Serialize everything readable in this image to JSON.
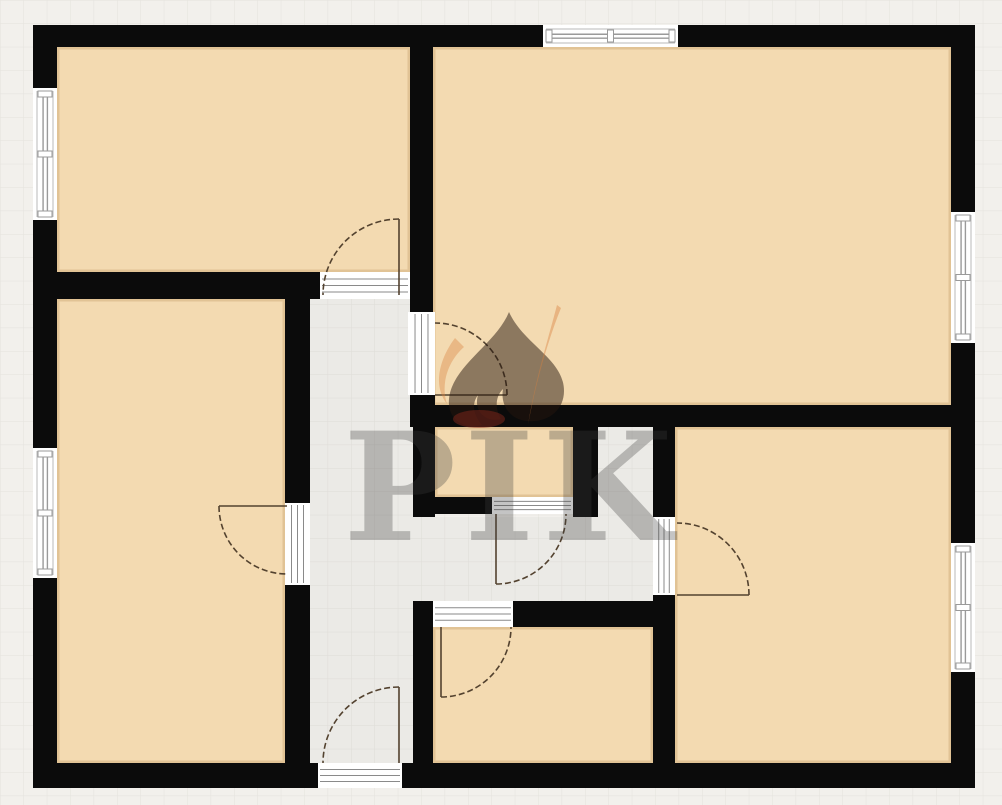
{
  "watermark": {
    "text": "PIK",
    "logo": "pik-flame-logo"
  },
  "palette": {
    "background": "#f2f0ec",
    "grid_line": "#e4e2dd",
    "wall": "#0b0b0b",
    "room_fill": "#f3dab1",
    "room_edge": "rgba(193,152,98,0.35)",
    "corridor_fill": "#ebeae6",
    "corridor_grid_line": "#dedcd7",
    "window_frame": "#9a9a9a",
    "window_edge": "#b8b8b8",
    "opening_line": "#8a8a8a",
    "door_arc": "#53422f",
    "watermark_text": "#3e3e3e",
    "watermark_dark": "#26160d",
    "watermark_orange": "#d9813f",
    "watermark_red": "#8d2a1d"
  },
  "floorplan": {
    "canvas": {
      "width": 1002,
      "height": 805
    },
    "grid_size": 23.4,
    "outer_walls": [
      [
        33,
        25,
        942,
        22
      ],
      [
        33,
        763,
        942,
        25
      ],
      [
        33,
        25,
        24,
        763
      ],
      [
        951,
        25,
        24,
        763
      ]
    ],
    "inner_walls": [
      [
        410,
        47,
        23,
        252
      ],
      [
        33,
        272,
        287,
        27
      ],
      [
        285,
        299,
        25,
        204
      ],
      [
        285,
        585,
        25,
        178
      ],
      [
        410,
        299,
        23,
        13
      ],
      [
        410,
        395,
        25,
        32
      ],
      [
        413,
        405,
        540,
        22
      ],
      [
        413,
        427,
        22,
        90
      ],
      [
        573,
        427,
        25,
        90
      ],
      [
        435,
        497,
        57,
        17
      ],
      [
        653,
        427,
        22,
        90
      ],
      [
        653,
        595,
        22,
        168
      ],
      [
        413,
        601,
        20,
        162
      ],
      [
        513,
        601,
        140,
        26
      ]
    ],
    "rooms": [
      {
        "name": "room-top-left",
        "rect": [
          57,
          47,
          353,
          225
        ]
      },
      {
        "name": "room-top-right",
        "rect": [
          433,
          47,
          518,
          358
        ]
      },
      {
        "name": "room-left",
        "rect": [
          57,
          299,
          228,
          464
        ]
      },
      {
        "name": "room-middle-small",
        "rect": [
          435,
          427,
          138,
          70
        ]
      },
      {
        "name": "room-bottom-right",
        "rect": [
          675,
          427,
          276,
          336
        ]
      },
      {
        "name": "room-bottom-middle",
        "rect": [
          433,
          627,
          220,
          136
        ]
      }
    ],
    "corridor": [
      [
        310,
        299,
        103,
        464
      ],
      [
        413,
        517,
        240,
        84
      ],
      [
        595,
        427,
        58,
        90
      ]
    ],
    "windows": [
      {
        "orient": "v",
        "rect": [
          33,
          88,
          24,
          132
        ]
      },
      {
        "orient": "v",
        "rect": [
          33,
          448,
          24,
          130
        ]
      },
      {
        "orient": "h",
        "rect": [
          543,
          25,
          135,
          22
        ]
      },
      {
        "orient": "v",
        "rect": [
          951,
          212,
          24,
          131
        ]
      },
      {
        "orient": "v",
        "rect": [
          951,
          543,
          24,
          129
        ]
      }
    ],
    "openings": [
      {
        "orient": "h",
        "rect": [
          320,
          272,
          90,
          27
        ]
      },
      {
        "orient": "v",
        "rect": [
          408,
          312,
          27,
          83
        ]
      },
      {
        "orient": "v",
        "rect": [
          285,
          503,
          25,
          82
        ]
      },
      {
        "orient": "h",
        "rect": [
          492,
          497,
          81,
          17
        ]
      },
      {
        "orient": "h",
        "rect": [
          433,
          601,
          80,
          26
        ]
      },
      {
        "orient": "v",
        "rect": [
          653,
          517,
          22,
          78
        ]
      },
      {
        "orient": "h",
        "rect": [
          318,
          763,
          84,
          25
        ]
      }
    ],
    "doors": [
      {
        "hinge": [
          399,
          295
        ],
        "radius": 76,
        "leaf_deg": 270,
        "closed_deg": 180
      },
      {
        "hinge": [
          435,
          395
        ],
        "radius": 72,
        "leaf_deg": 0,
        "closed_deg": 270
      },
      {
        "hinge": [
          287,
          506
        ],
        "radius": 68,
        "leaf_deg": 180,
        "closed_deg": 90
      },
      {
        "hinge": [
          496,
          514
        ],
        "radius": 70,
        "leaf_deg": 90,
        "closed_deg": 0
      },
      {
        "hinge": [
          441,
          627
        ],
        "radius": 70,
        "leaf_deg": 90,
        "closed_deg": 0
      },
      {
        "hinge": [
          677,
          595
        ],
        "radius": 72,
        "leaf_deg": 0,
        "closed_deg": 270
      },
      {
        "hinge": [
          399,
          763
        ],
        "radius": 76,
        "leaf_deg": 270,
        "closed_deg": 180
      }
    ]
  }
}
